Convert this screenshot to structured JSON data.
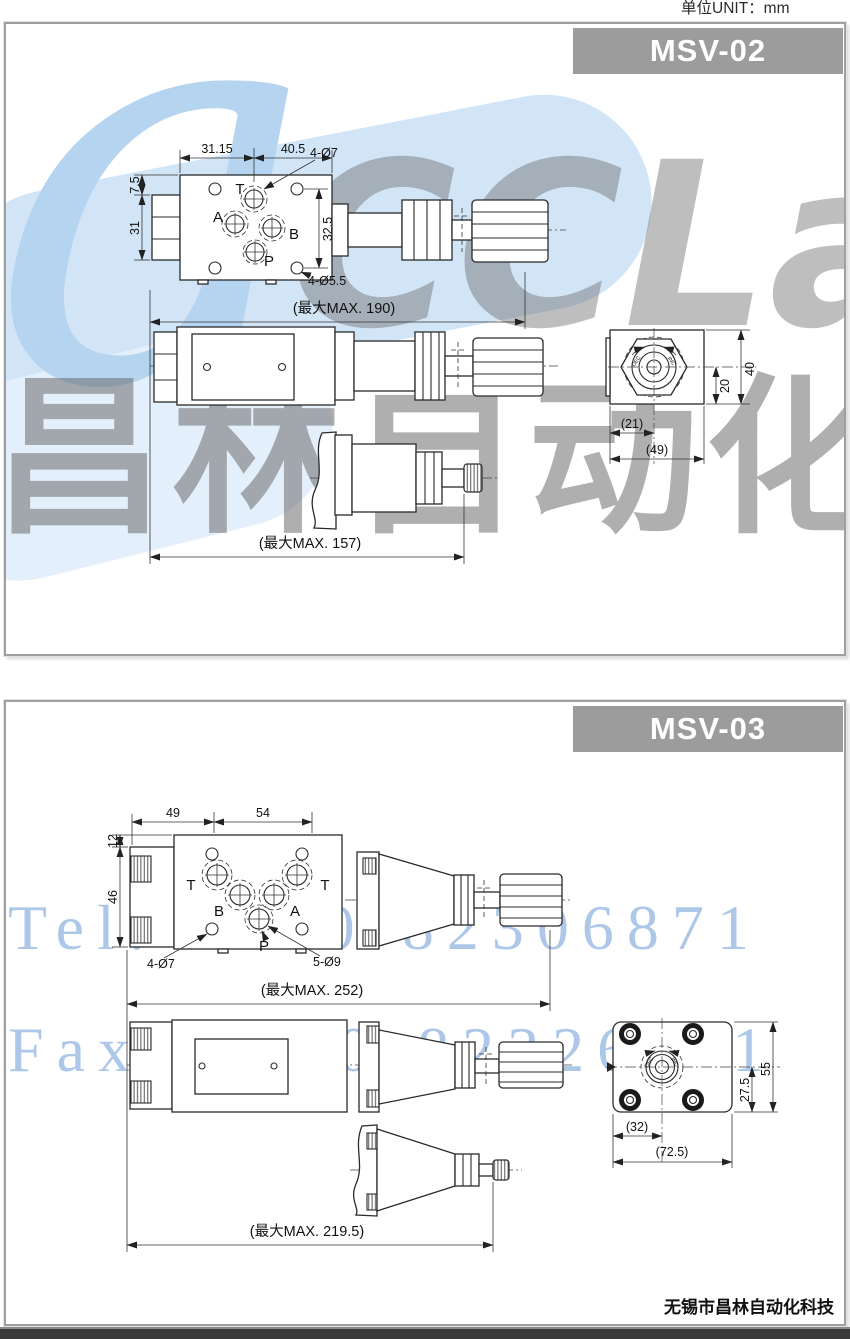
{
  "page": {
    "unit_label": "单位UNIT：mm",
    "footer_company": "无锡市昌林自动化科技"
  },
  "watermarks": {
    "logo_text": "CCLair",
    "logo_accent": "a",
    "company_cn": "昌林自动化",
    "tel": "Tel: 0510-82306871",
    "fax": "Fax: 0510-82326771",
    "colors": {
      "blue_text": "#a4c2e6",
      "blue_fill": "#d2e5f7",
      "gray_text": "#8a8a8a"
    }
  },
  "msv02": {
    "title": "MSV-02",
    "ports": {
      "t": "T",
      "a": "A",
      "b": "B",
      "p": "P"
    },
    "top_view": {
      "w1": "31.15",
      "w2": "40.5",
      "port_holes": "4-Ø7",
      "h1": "7.5",
      "h2": "31",
      "h3": "32.5",
      "mount_holes": "4-Ø5.5"
    },
    "lengths": {
      "knob_type": "(最大MAX. 190)",
      "screw_type": "(最大MAX. 157)"
    },
    "end_view": {
      "w_inner": "(21)",
      "w_outer": "(49)",
      "h_inner": "20",
      "h_outer": "40",
      "dec": "DEC",
      "inc": "INC"
    }
  },
  "msv03": {
    "title": "MSV-03",
    "ports": {
      "t1": "T",
      "b": "B",
      "a": "A",
      "t2": "T",
      "p": "P"
    },
    "top_view": {
      "w1": "49",
      "w2": "54",
      "h1": "12",
      "h2": "46",
      "mount_holes": "4-Ø7",
      "port_holes": "5-Ø9"
    },
    "lengths": {
      "knob_type": "(最大MAX. 252)",
      "screw_type": "(最大MAX. 219.5)"
    },
    "end_view": {
      "w_inner": "(32)",
      "w_outer": "(72.5)",
      "h_inner": "27.5",
      "h_outer": "55",
      "dec": "DEC",
      "inc": "INC"
    }
  }
}
